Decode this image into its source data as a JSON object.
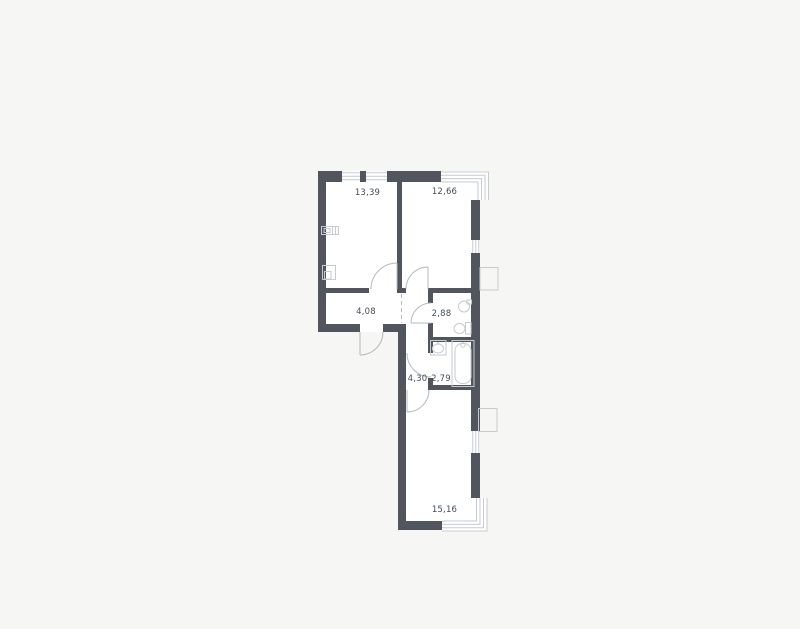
{
  "plan": {
    "type": "apartment-floor-plan",
    "rooms": [
      {
        "key": "room-top-left",
        "area": "13,39"
      },
      {
        "key": "room-top-right",
        "area": "12,66"
      },
      {
        "key": "hallway",
        "area": "4,08"
      },
      {
        "key": "wc",
        "area": "2,88"
      },
      {
        "key": "corridor",
        "area": "4,30"
      },
      {
        "key": "bathroom",
        "area": "2,79"
      },
      {
        "key": "room-bottom",
        "area": "15,16"
      }
    ],
    "fixtures": [
      "electrical-panel",
      "utility-box",
      "round-sink",
      "toilet",
      "washbasin",
      "bathtub",
      "ac-basket-top",
      "ac-basket-bottom"
    ],
    "openings": [
      "entrance-door",
      "door-room-top-left",
      "door-room-top-right",
      "door-wc",
      "door-bathroom",
      "door-room-bottom",
      "window-top-1",
      "window-top-2",
      "window-right-top",
      "window-right-bottom",
      "corner-glazing-top-right",
      "corner-glazing-bottom-right"
    ],
    "colors": {
      "background": "#f6f6f5",
      "floor": "#ffffff",
      "wall": "#51565e",
      "thin_line": "#c6cbd0",
      "door_line": "#b3bac0",
      "label": "#434c55"
    }
  }
}
